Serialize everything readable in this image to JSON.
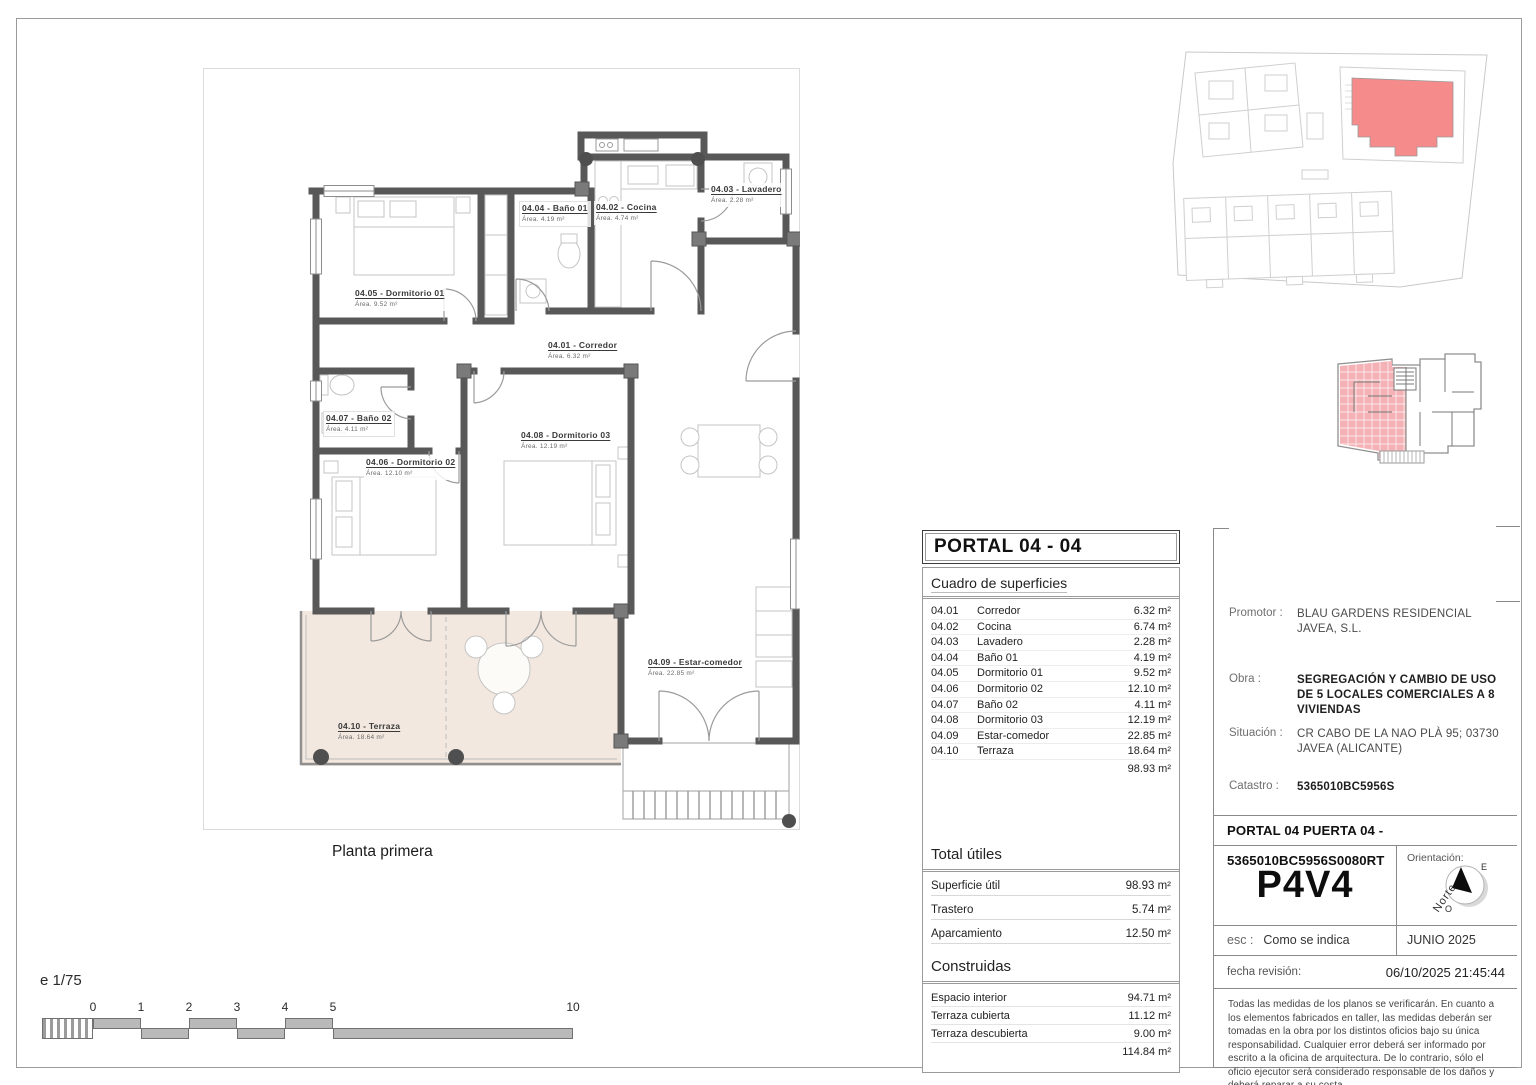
{
  "plan": {
    "caption": "Planta primera",
    "scale_note": "e 1/75",
    "scale_ticks": [
      "0",
      "1",
      "2",
      "3",
      "4",
      "5",
      "10"
    ],
    "rooms": [
      {
        "code": "04.01",
        "label": "04.01 - Corredor",
        "area": "Área. 6.32 m²"
      },
      {
        "code": "04.02",
        "label": "04.02 - Cocina",
        "area": "Área. 4.74 m²"
      },
      {
        "code": "04.03",
        "label": "04.03 - Lavadero",
        "area": "Área. 2.28 m²"
      },
      {
        "code": "04.04",
        "label": "04.04 - Baño 01",
        "area": "Área. 4.19 m²"
      },
      {
        "code": "04.05",
        "label": "04.05 - Dormitorio 01",
        "area": "Área. 9.52 m²"
      },
      {
        "code": "04.06",
        "label": "04.06 - Dormitorio 02",
        "area": "Área. 12.10 m²"
      },
      {
        "code": "04.07",
        "label": "04.07 - Baño 02",
        "area": "Área. 4.11 m²"
      },
      {
        "code": "04.08",
        "label": "04.08 - Dormitorio 03",
        "area": "Área. 12.19 m²"
      },
      {
        "code": "04.09",
        "label": "04.09 - Estar-comedor",
        "area": "Área. 22.85 m²"
      },
      {
        "code": "04.10",
        "label": "04.10 - Terraza",
        "area": "Área. 18.64 m²"
      }
    ]
  },
  "surface_table": {
    "title": "PORTAL 04 - 04",
    "subtitle": "Cuadro de superficies",
    "rows": [
      {
        "code": "04.01",
        "name": "Corredor",
        "value": "6.32 m²"
      },
      {
        "code": "04.02",
        "name": "Cocina",
        "value": "6.74 m²"
      },
      {
        "code": "04.03",
        "name": "Lavadero",
        "value": "2.28 m²"
      },
      {
        "code": "04.04",
        "name": "Baño 01",
        "value": "4.19 m²"
      },
      {
        "code": "04.05",
        "name": "Dormitorio 01",
        "value": "9.52 m²"
      },
      {
        "code": "04.06",
        "name": "Dormitorio 02",
        "value": "12.10 m²"
      },
      {
        "code": "04.07",
        "name": "Baño 02",
        "value": "4.11 m²"
      },
      {
        "code": "04.08",
        "name": "Dormitorio 03",
        "value": "12.19 m²"
      },
      {
        "code": "04.09",
        "name": "Estar-comedor",
        "value": "22.85 m²"
      },
      {
        "code": "04.10",
        "name": "Terraza",
        "value": "18.64 m²"
      }
    ],
    "rows_total": "98.93 m²",
    "utiles_heading": "Total útiles",
    "utiles_rows": [
      {
        "label": "Superficie útil",
        "value": "98.93 m²"
      },
      {
        "label": "Trastero",
        "value": "5.74 m²"
      },
      {
        "label": "Aparcamiento",
        "value": "12.50 m²"
      }
    ],
    "construidas_heading": "Construidas",
    "construidas_rows": [
      {
        "label": "Espacio interior",
        "value": "94.71 m²"
      },
      {
        "label": "Terraza cubierta",
        "value": "11.12 m²"
      },
      {
        "label": "Terraza descubierta",
        "value": "9.00 m²"
      }
    ],
    "construidas_total": "114.84 m²"
  },
  "title_block": {
    "promotor_label": "Promotor :",
    "promotor_value": "BLAU GARDENS RESIDENCIAL JAVEA, S.L.",
    "obra_label": "Obra :",
    "obra_value": "SEGREGACIÓN Y CAMBIO DE USO DE 5 LOCALES COMERCIALES A 8 VIVIENDAS",
    "situacion_label": "Situación :",
    "situacion_value": "CR CABO DE LA NAO PLÀ 95; 03730 JAVEA (ALICANTE)",
    "catastro_label": "Catastro :",
    "catastro_value": "5365010BC5956S",
    "portal_line": "PORTAL 04 PUERTA 04 - 5365010BC5956S0080RT",
    "unit_code": "P4V4",
    "orientation_label": "Orientación:",
    "compass_north": "Norte",
    "compass_e": "E",
    "compass_o": "O",
    "esc_label": "esc :",
    "esc_value": "Como se indica",
    "date": "JUNIO 2025",
    "revision_label": "fecha revisión:",
    "revision_value": "06/10/2025 21:45:44",
    "disclaimer": "Todas las medidas de los planos se verificarán. En cuanto a los elementos fabricados en taller, las medidas deberán ser tomadas en la obra por los distintos oficios bajo su única responsabilidad. Cualquier error deberá ser informado por escrito a la oficina de arquitectura. De lo contrario, sólo el oficio ejecutor será considerado responsable de los daños y deberá reparar a su costa."
  },
  "colors": {
    "wall": "#585858",
    "terrace_fill": "#f3e8df",
    "site_highlight": "#f58b8b",
    "keyplan_highlight": "#f4b2b6"
  }
}
